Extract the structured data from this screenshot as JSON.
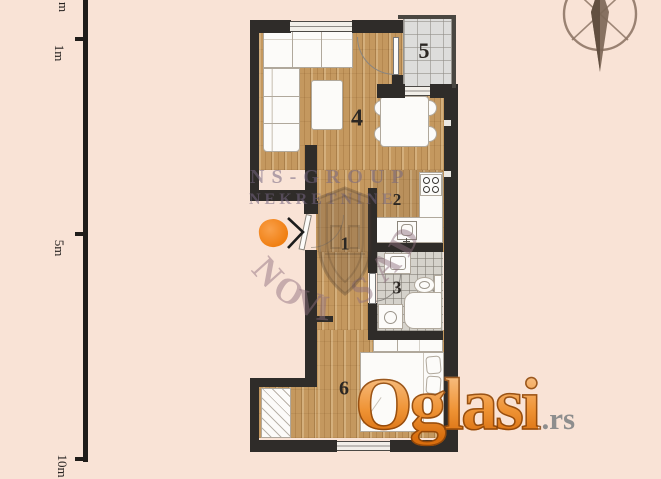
{
  "title": "apartment-floor-plan",
  "scale_ruler": {
    "labels": [
      "m",
      "1m",
      "5m",
      "10m"
    ]
  },
  "rooms": {
    "r1": "1",
    "r2": "2",
    "r3": "3",
    "r4": "4",
    "r5": "5",
    "r6": "6"
  },
  "watermarks": {
    "agency_name": "NS-GROUP",
    "agency_type": "NEKRETNINE",
    "agency_city": "NOVI SAD",
    "site_name": "Oglasi",
    "site_tld": ".rs"
  },
  "icons": {
    "compass": "compass-rose-icon",
    "entrance_arrow": "chevron-right-icon",
    "entrance_marker": "orange-entrance-marker",
    "agency_logo": "shield-logo-icon"
  },
  "colors": {
    "background": "#f9e3d6",
    "wall": "#2f2c29",
    "wood_floor": "#c4985f",
    "bath_tile": "#d5d2cb",
    "terrace_tile": "#dddddb",
    "entrance_orange": "#f07f12",
    "oglasi_orange": "#ef9436",
    "oglasi_tld_gray": "#8e8e8e",
    "watermark_purple": "rgba(116,102,130,0.55)"
  }
}
